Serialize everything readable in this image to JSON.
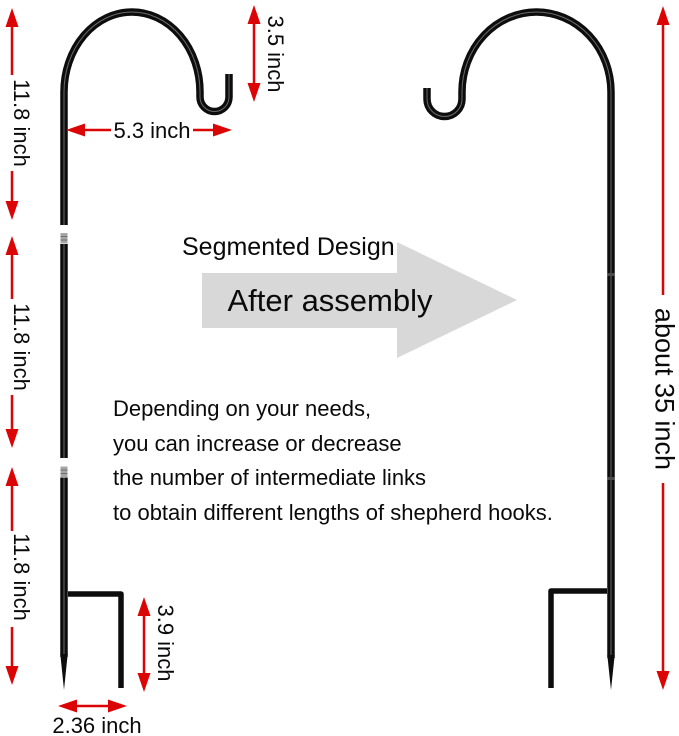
{
  "heading": {
    "segmented_design": "Segmented Design",
    "after_assembly": "After assembly"
  },
  "description_lines": [
    "Depending on your needs,",
    "you can increase or decrease",
    "the number of intermediate links",
    "to obtain different lengths of shepherd hooks."
  ],
  "dimensions": {
    "segment1": "11.8 inch",
    "segment2": "11.8 inch",
    "segment3": "11.8 inch",
    "hook_drop": "3.5 inch",
    "hook_width": "5.3 inch",
    "leg_height": "3.9 inch",
    "leg_width": "2.36 inch",
    "total_height": "about 35 inch"
  },
  "colors": {
    "dimension_red": "#dc0505",
    "assembly_arrow_gray": "#d8d8d8",
    "metal_black": "#0d0d0d",
    "connector_gray": "#a6a6a6",
    "background": "#ffffff"
  }
}
